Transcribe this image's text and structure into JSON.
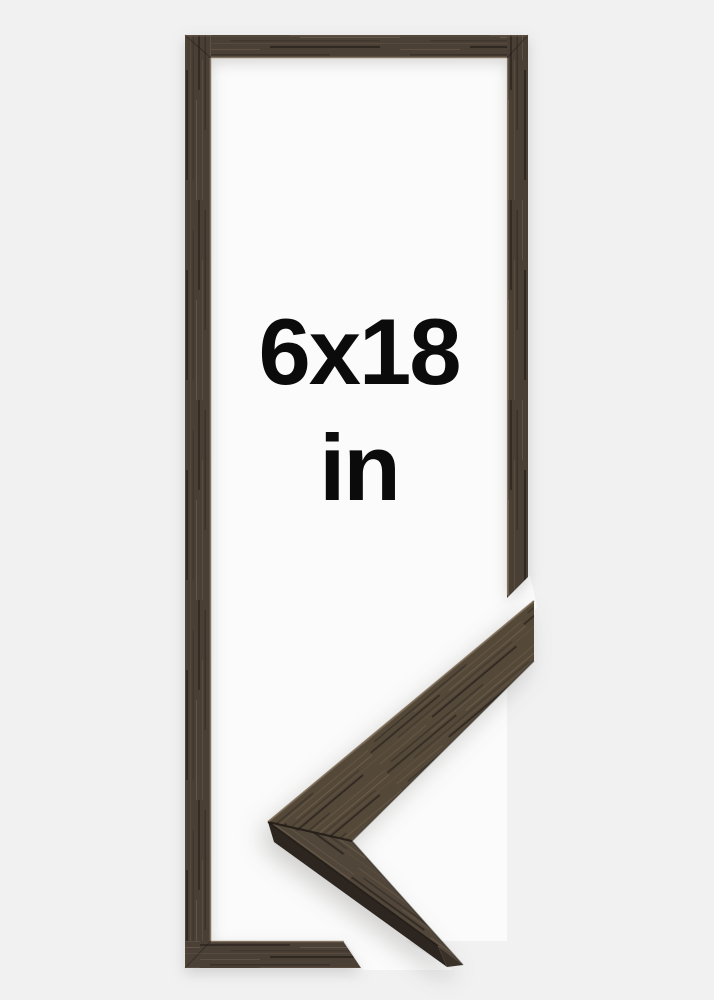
{
  "product_image": {
    "size_label": "6x18",
    "unit_label": "in",
    "subject": "dark walnut wood picture frame, portrait 6x18 inches, with magnified corner moulding detail",
    "colors": {
      "background": "#f1f1f2",
      "frame_opening": "#fbfbfb",
      "wood_base": "#4b4036",
      "wood_dark_streak": "#332b24",
      "wood_light_streak": "#63structure5547",
      "wood_side_face": "#2d2620",
      "inner_lip_highlight": "#8e7e6b",
      "text": "#0b0b0b"
    }
  }
}
